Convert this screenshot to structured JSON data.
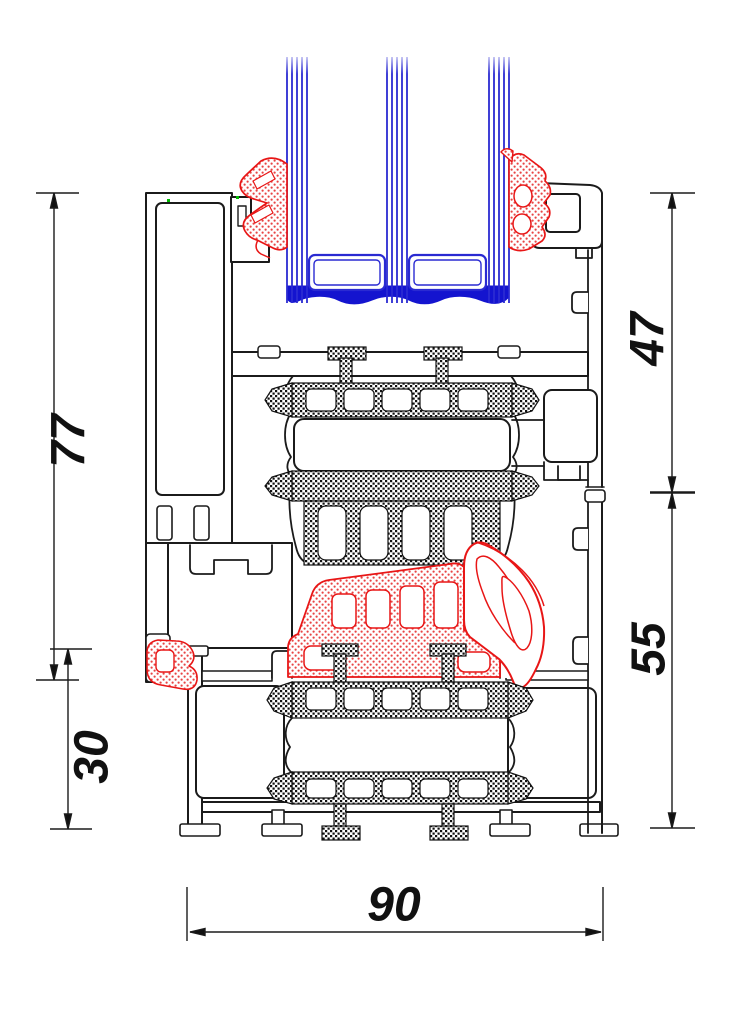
{
  "diagram": {
    "type": "technical-cross-section",
    "subject": "aluminum window profile with triple glazing",
    "dimension_labels": {
      "sash_height": "77",
      "overlap_height": "30",
      "sash_visible_height": "47",
      "frame_height": "55",
      "frame_depth": "90"
    },
    "colors": {
      "outline": "#1b1b1b",
      "glazing": "#2a2ad2",
      "sealant": "#1414cf",
      "gasket": "#e81616",
      "marker": "#00bb00",
      "background": "#ffffff"
    }
  }
}
